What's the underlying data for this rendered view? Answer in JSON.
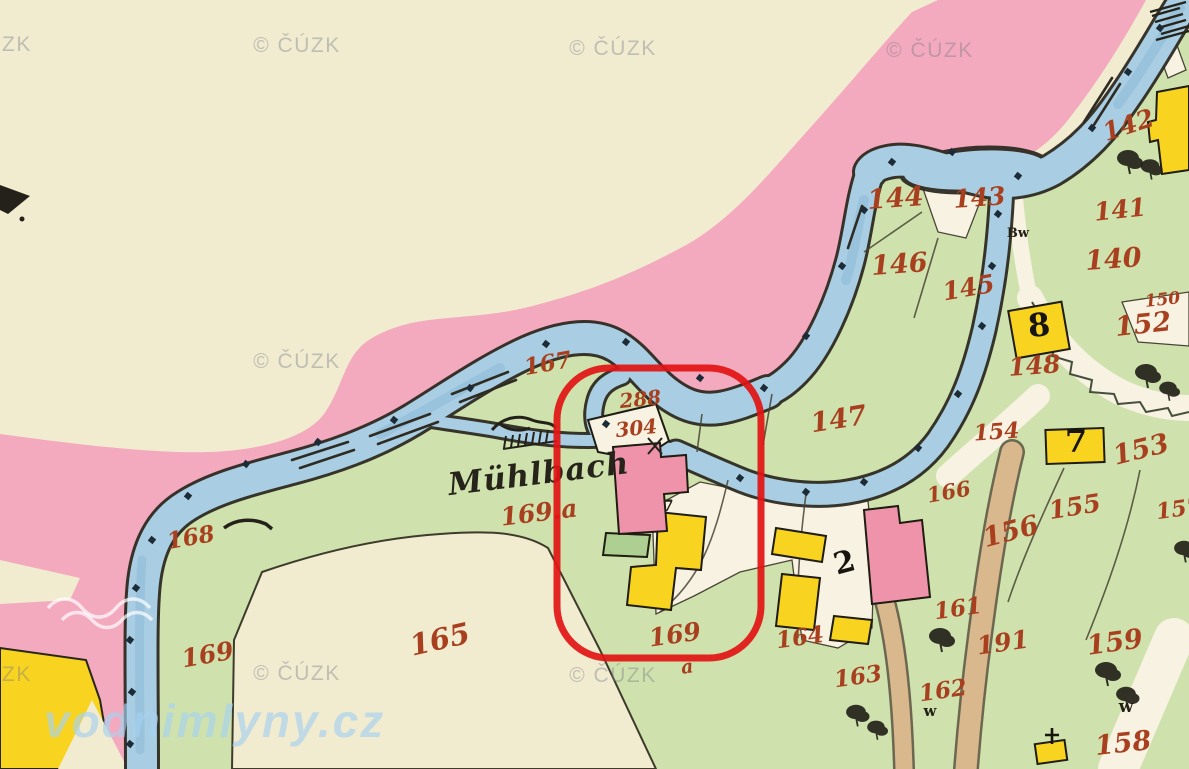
{
  "map": {
    "region_label": "Mühlbach",
    "colors": {
      "cream": "#f1ebd0",
      "pink_band": "#f3a9be",
      "green": "#cfe2ad",
      "green_dark_parcel": "#aecf92",
      "water": "#a9cee3",
      "water_shade": "#86b4d3",
      "bank": "#2e2b22",
      "yellow_building": "#f8d320",
      "pink_building": "#ef93aa",
      "tan_road": "#d8b88c",
      "road_white": "#f7f2e2",
      "ink_red": "#a8401f",
      "annotation_red": "#e21414",
      "hatch": "#5a6340"
    },
    "annotation": {
      "shape": "rounded-rect",
      "x": 557,
      "y": 368,
      "width": 204,
      "height": 290,
      "radius": 52,
      "stroke_width": 7
    },
    "labels": [
      {
        "text": "142",
        "x": 1131,
        "y": 133,
        "rot": -18,
        "size": 25
      },
      {
        "text": "141",
        "x": 1121,
        "y": 218,
        "rot": -6,
        "size": 25
      },
      {
        "text": "144",
        "x": 896,
        "y": 207,
        "rot": -4,
        "size": 27
      },
      {
        "text": "143",
        "x": 980,
        "y": 206,
        "rot": -4,
        "size": 25
      },
      {
        "text": "146",
        "x": 900,
        "y": 273,
        "rot": -4,
        "size": 27
      },
      {
        "text": "145",
        "x": 970,
        "y": 296,
        "rot": -10,
        "size": 25
      },
      {
        "text": "140",
        "x": 1114,
        "y": 268,
        "rot": -4,
        "size": 27
      },
      {
        "text": "150",
        "x": 1163,
        "y": 305,
        "rot": -6,
        "size": 17
      },
      {
        "text": "152",
        "x": 1144,
        "y": 333,
        "rot": -6,
        "size": 27
      },
      {
        "text": "148",
        "x": 1035,
        "y": 374,
        "rot": -4,
        "size": 25
      },
      {
        "text": "147",
        "x": 840,
        "y": 428,
        "rot": -9,
        "size": 27
      },
      {
        "text": "154",
        "x": 997,
        "y": 439,
        "rot": -4,
        "size": 22
      },
      {
        "text": "153",
        "x": 1143,
        "y": 458,
        "rot": -14,
        "size": 27
      },
      {
        "text": "157",
        "x": 1180,
        "y": 516,
        "rot": -8,
        "size": 22
      },
      {
        "text": "167",
        "x": 549,
        "y": 371,
        "rot": -10,
        "size": 23
      },
      {
        "text": "288",
        "x": 641,
        "y": 406,
        "rot": -6,
        "size": 20
      },
      {
        "text": "304",
        "x": 637,
        "y": 435,
        "rot": -6,
        "size": 20
      },
      {
        "text": "166",
        "x": 950,
        "y": 499,
        "rot": -10,
        "size": 21
      },
      {
        "text": "155",
        "x": 1076,
        "y": 515,
        "rot": -9,
        "size": 25
      },
      {
        "text": "156",
        "x": 1013,
        "y": 540,
        "rot": -15,
        "size": 27
      },
      {
        "text": "169.a",
        "x": 540,
        "y": 521,
        "rot": -7,
        "size": 25
      },
      {
        "text": "168",
        "x": 192,
        "y": 545,
        "rot": -10,
        "size": 23
      },
      {
        "text": "165",
        "x": 442,
        "y": 649,
        "rot": -13,
        "size": 29
      },
      {
        "text": "169",
        "x": 209,
        "y": 663,
        "rot": -10,
        "size": 25
      },
      {
        "text": "169",
        "x": 676,
        "y": 643,
        "rot": -8,
        "size": 25
      },
      {
        "text": "a",
        "x": 688,
        "y": 673,
        "rot": -8,
        "size": 19
      },
      {
        "text": "164",
        "x": 801,
        "y": 645,
        "rot": -8,
        "size": 23
      },
      {
        "text": "161",
        "x": 959,
        "y": 616,
        "rot": -8,
        "size": 23
      },
      {
        "text": "163",
        "x": 859,
        "y": 684,
        "rot": -8,
        "size": 23
      },
      {
        "text": "162",
        "x": 944,
        "y": 698,
        "rot": -8,
        "size": 23
      },
      {
        "text": "191",
        "x": 1004,
        "y": 651,
        "rot": -8,
        "size": 25
      },
      {
        "text": "159",
        "x": 1116,
        "y": 651,
        "rot": -8,
        "size": 27
      },
      {
        "text": "158",
        "x": 1124,
        "y": 752,
        "rot": -6,
        "size": 27
      },
      {
        "text": "Mühlbach",
        "x": 540,
        "y": 484,
        "rot": -7,
        "size": 31,
        "cls": "script",
        "name": "stream-name-label"
      },
      {
        "text": "2",
        "x": 847,
        "y": 572,
        "rot": -15,
        "size": 30,
        "cls": "house",
        "name": "house-number-label"
      },
      {
        "text": "7",
        "x": 1076,
        "y": 452,
        "rot": 0,
        "size": 32,
        "cls": "house",
        "name": "house-number-label"
      },
      {
        "text": "8",
        "x": 1040,
        "y": 336,
        "rot": -5,
        "size": 32,
        "cls": "house",
        "name": "house-number-label"
      },
      {
        "text": "7",
        "x": 668,
        "y": 511,
        "rot": 0,
        "size": 16,
        "cls": "house-sm",
        "name": "house-number-label"
      },
      {
        "text": "Bw",
        "x": 1018,
        "y": 237,
        "rot": 0,
        "size": 13,
        "cls": "house-sm",
        "name": "map-abbrev-label"
      },
      {
        "text": "w",
        "x": 1126,
        "y": 712,
        "rot": 0,
        "size": 17,
        "cls": "house-sm",
        "name": "map-abbrev-label"
      },
      {
        "text": "w",
        "x": 930,
        "y": 716,
        "rot": 0,
        "size": 15,
        "cls": "house-sm",
        "name": "map-abbrev-label"
      }
    ],
    "watermarks": {
      "cuzk_text": "© ČÚZK",
      "cuzk_positions": [
        {
          "x": 297,
          "y": 52
        },
        {
          "x": 613,
          "y": 55
        },
        {
          "x": 930,
          "y": 57
        },
        {
          "x": 297,
          "y": 368
        },
        {
          "x": 297,
          "y": 680
        },
        {
          "x": 613,
          "y": 682
        }
      ],
      "partial_text": "ZK",
      "partial_positions": [
        {
          "x": 2,
          "y": 51
        },
        {
          "x": 2,
          "y": 681
        }
      ],
      "site_text": "vodnimlyny.cz",
      "site_position": {
        "x": 44,
        "y": 737,
        "size": 46
      }
    },
    "boundary_stones": [
      {
        "x": 188,
        "y": 496
      },
      {
        "x": 246,
        "y": 464
      },
      {
        "x": 318,
        "y": 442
      },
      {
        "x": 394,
        "y": 420
      },
      {
        "x": 470,
        "y": 388
      },
      {
        "x": 546,
        "y": 344
      },
      {
        "x": 626,
        "y": 342
      },
      {
        "x": 700,
        "y": 378
      },
      {
        "x": 764,
        "y": 388
      },
      {
        "x": 806,
        "y": 336
      },
      {
        "x": 842,
        "y": 266
      },
      {
        "x": 864,
        "y": 210
      },
      {
        "x": 892,
        "y": 162
      },
      {
        "x": 952,
        "y": 152
      },
      {
        "x": 1018,
        "y": 176
      },
      {
        "x": 1092,
        "y": 128
      },
      {
        "x": 1128,
        "y": 72
      },
      {
        "x": 1160,
        "y": 28
      },
      {
        "x": 998,
        "y": 214
      },
      {
        "x": 992,
        "y": 266
      },
      {
        "x": 982,
        "y": 326
      },
      {
        "x": 958,
        "y": 394
      },
      {
        "x": 918,
        "y": 448
      },
      {
        "x": 864,
        "y": 482
      },
      {
        "x": 806,
        "y": 492
      },
      {
        "x": 740,
        "y": 478
      },
      {
        "x": 152,
        "y": 540
      },
      {
        "x": 136,
        "y": 588
      },
      {
        "x": 130,
        "y": 640
      },
      {
        "x": 132,
        "y": 692
      },
      {
        "x": 130,
        "y": 744
      },
      {
        "x": 606,
        "y": 424
      }
    ],
    "trees": [
      {
        "x": 1128,
        "y": 158,
        "s": 1
      },
      {
        "x": 1150,
        "y": 166,
        "s": 0.85
      },
      {
        "x": 1146,
        "y": 372,
        "s": 1
      },
      {
        "x": 1168,
        "y": 388,
        "s": 0.8
      },
      {
        "x": 940,
        "y": 636,
        "s": 1
      },
      {
        "x": 856,
        "y": 712,
        "s": 0.9
      },
      {
        "x": 876,
        "y": 727,
        "s": 0.8
      },
      {
        "x": 1106,
        "y": 670,
        "s": 1
      },
      {
        "x": 1126,
        "y": 694,
        "s": 0.9
      },
      {
        "x": 1184,
        "y": 548,
        "s": 0.9
      }
    ]
  }
}
